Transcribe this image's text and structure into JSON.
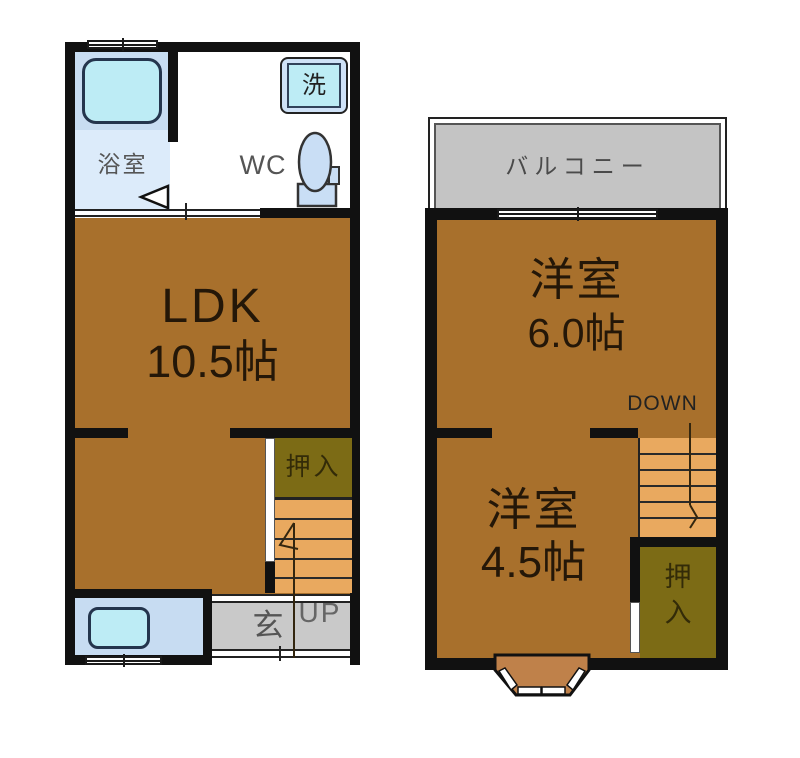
{
  "plan_title": "2-story floor plan",
  "f1": {
    "bath_label": "浴室",
    "washer_label": "洗",
    "wc_label": "WC",
    "ldk_label": "LDK",
    "ldk_size": "10.5帖",
    "closet_label": "押入",
    "entrance_label": "玄",
    "up_label": "UP"
  },
  "f2": {
    "balcony_label": "バルコニー",
    "room1_label": "洋室",
    "room1_size": "6.0帖",
    "down_label": "DOWN",
    "room2_label": "洋室",
    "room2_size": "4.5帖",
    "closet_top": "押",
    "closet_bottom": "入"
  },
  "colors": {
    "wall": "#111111",
    "room_floor": "#a8702c",
    "closet": "#7c6b15",
    "stairs": "#e9a95f",
    "balcony": "#c4c4c4",
    "entrance": "#c9c9c9",
    "bathroom": "#c8ddf2",
    "fixture": "#bdecf5",
    "fixture_panel": "#cfe2f7",
    "bay_window": "#bf814a"
  }
}
